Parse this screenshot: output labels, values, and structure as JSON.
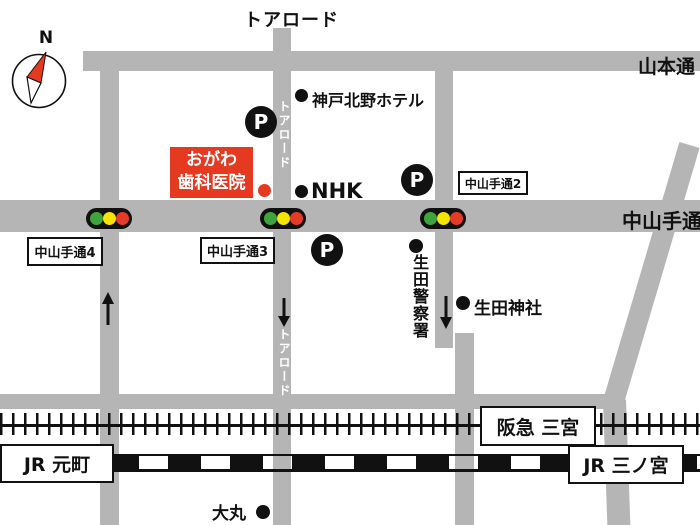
{
  "map_title": "トアロード",
  "compass": {
    "label": "N"
  },
  "roads": {
    "yamamoto_label": "山本通",
    "nakayamate_label": "中山手通",
    "tor_label_upper": "トアロード",
    "tor_label_lower": "トアロード"
  },
  "block_labels": {
    "nakayamate4": "中山手通4",
    "nakayamate3": "中山手通3",
    "nakayamate2": "中山手通2"
  },
  "places": {
    "clinic_line1": "おがわ",
    "clinic_line2": "歯科医院",
    "hotel": "神戸北野ホテル",
    "nhk": "NHK",
    "police": "生田警察署",
    "shrine": "生田神社",
    "daimaru": "大丸"
  },
  "stations": {
    "hankyu": "阪急 三宮",
    "jr_motomachi": "JR 元町",
    "jr_sannomiya": "JR 三ノ宮"
  },
  "parking_label": "P",
  "colors": {
    "road": "#b5b5b5",
    "clinic_red": "#e53a20",
    "signal_green": "#3fa43c",
    "signal_yellow": "#f6e400",
    "signal_red": "#e63b28"
  }
}
